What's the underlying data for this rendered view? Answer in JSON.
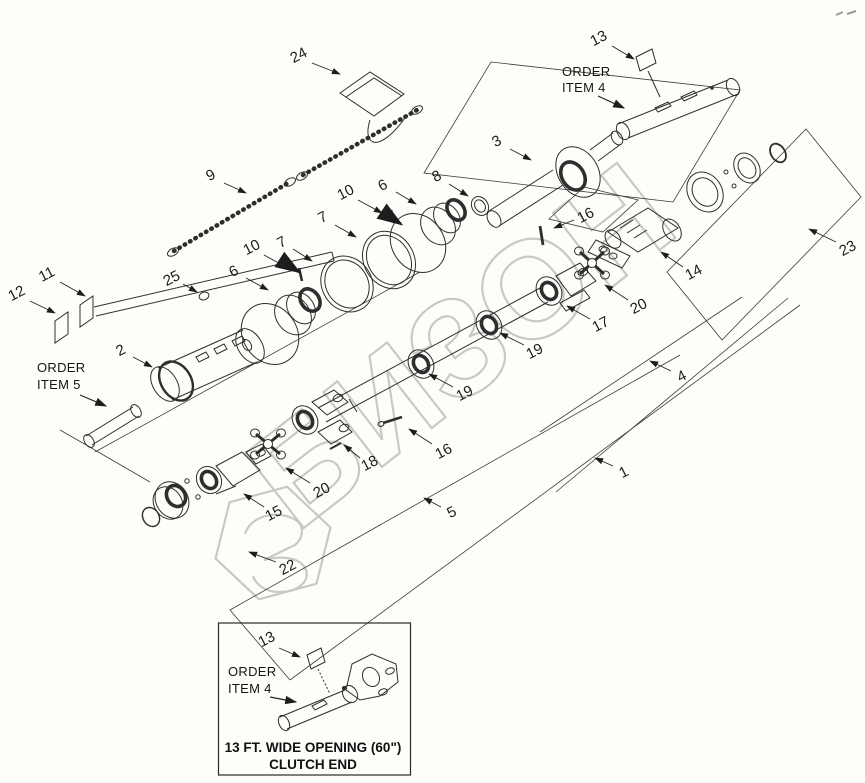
{
  "watermark": {
    "text": "БИЗОН",
    "color": "#c9c9c4"
  },
  "order_item_4_top": {
    "line1": "ORDER",
    "line2": "ITEM 4"
  },
  "order_item_5": {
    "line1": "ORDER",
    "line2": "ITEM 5"
  },
  "callouts": {
    "c1": "1",
    "c2": "2",
    "c3": "3",
    "c4": "4",
    "c5": "5",
    "c6a": "6",
    "c6b": "6",
    "c7a": "7",
    "c7b": "7",
    "c8": "8",
    "c9": "9",
    "c10a": "10",
    "c10b": "10",
    "c11": "11",
    "c12": "12",
    "c13_top": "13",
    "c14": "14",
    "c15": "15",
    "c16a": "16",
    "c16b": "16",
    "c17": "17",
    "c18": "18",
    "c19a": "19",
    "c19b": "19",
    "c20a": "20",
    "c20b": "20",
    "c22": "22",
    "c23": "23",
    "c24": "24",
    "c25": "25"
  },
  "inset": {
    "callout_13": "13",
    "order_line1": "ORDER",
    "order_line2": "ITEM 4",
    "caption_line1": "13 FT. WIDE OPENING (60\")",
    "caption_line2": "CLUTCH END"
  }
}
